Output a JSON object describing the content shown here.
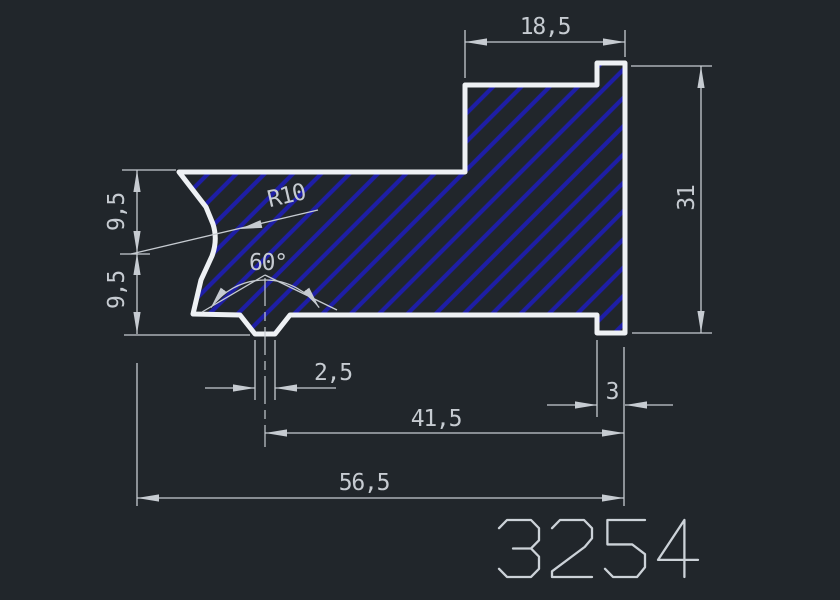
{
  "drawing": {
    "part_number": "3254",
    "colors": {
      "background": "#21262b",
      "outline": "#eef1f4",
      "hatch": "#1e1ea6",
      "dimension": "#c6cbd1",
      "part_number": "#ccd2d8"
    },
    "dimensions": {
      "top_width": "18,5",
      "right_height": "31",
      "left_upper_height": "9,5",
      "left_lower_height": "9,5",
      "fillet_radius": "R10",
      "groove_angle": "60°",
      "groove_bottom_width": "2,5",
      "right_lip_width": "3",
      "groove_center_to_right": "41,5",
      "overall_width": "56,5"
    }
  }
}
